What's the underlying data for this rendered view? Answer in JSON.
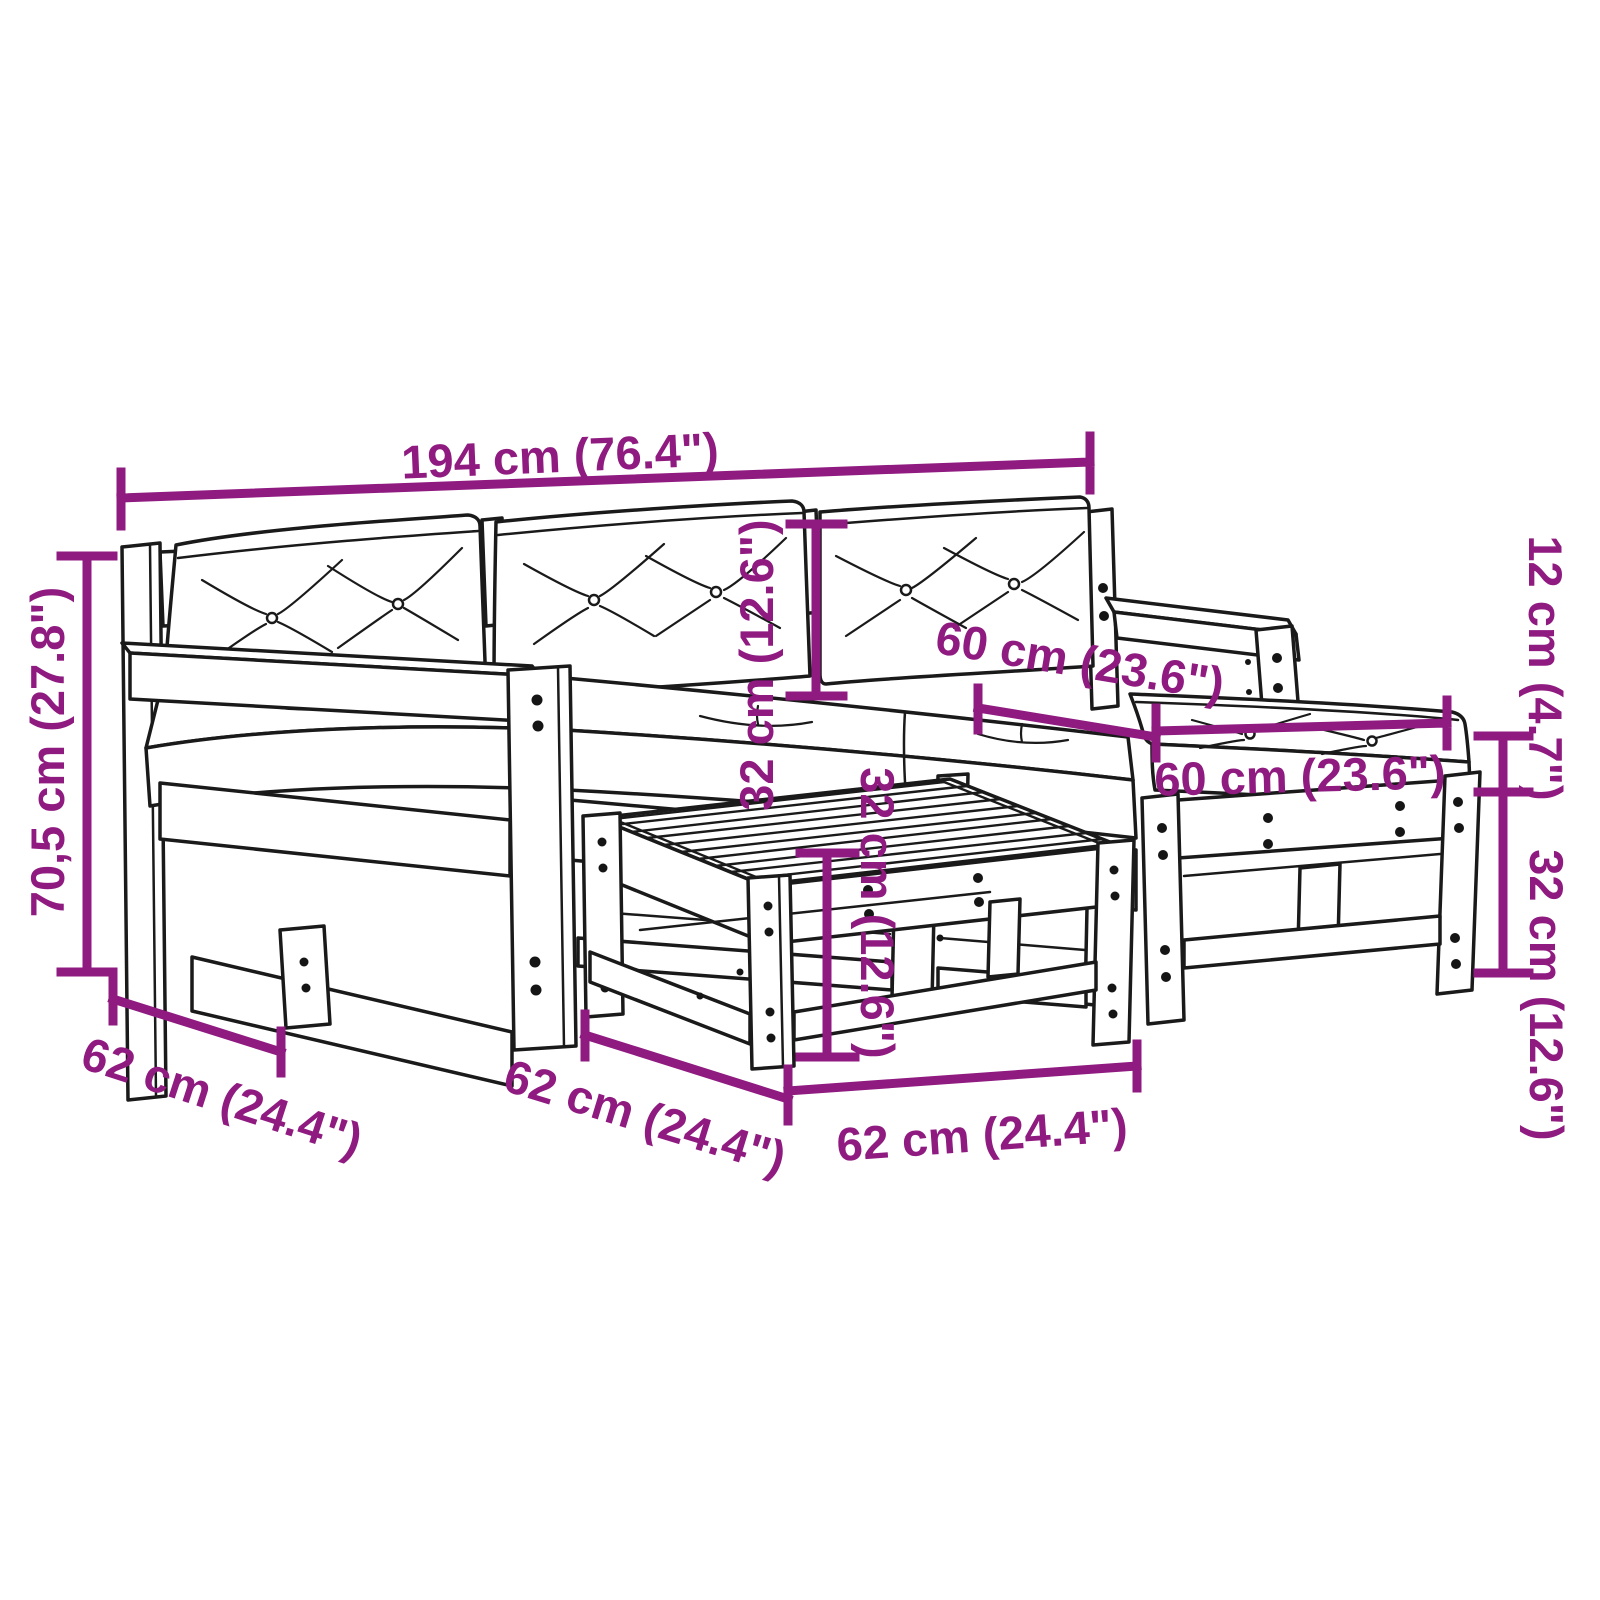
{
  "page": {
    "background_color": "#ffffff",
    "drawing_stroke_color": "#1a1a1a",
    "dimension_color": "#8F1A80",
    "drawing_style": "black-outline line drawing of 5-piece garden lounge set with cushions (sofa, ottoman, coffee table)"
  },
  "dimensions": {
    "sofa_width": "194 cm (76.4\")",
    "sofa_height": "70,5 cm (27.8\")",
    "backrest_cushion_height": "32 cm (12.6\")",
    "seat_depth": "60 cm (23.6\")",
    "ottoman_cushion_width": "60 cm (23.6\")",
    "cushion_thickness": "12 cm (4.7\")",
    "ottoman_frame_height": "32 cm (12.6\")",
    "sofa_depth": "62 cm (24.4\")",
    "table_depth": "62 cm (24.4\")",
    "table_width": "62 cm (24.4\")",
    "table_height": "32 cm (12.6\")"
  }
}
